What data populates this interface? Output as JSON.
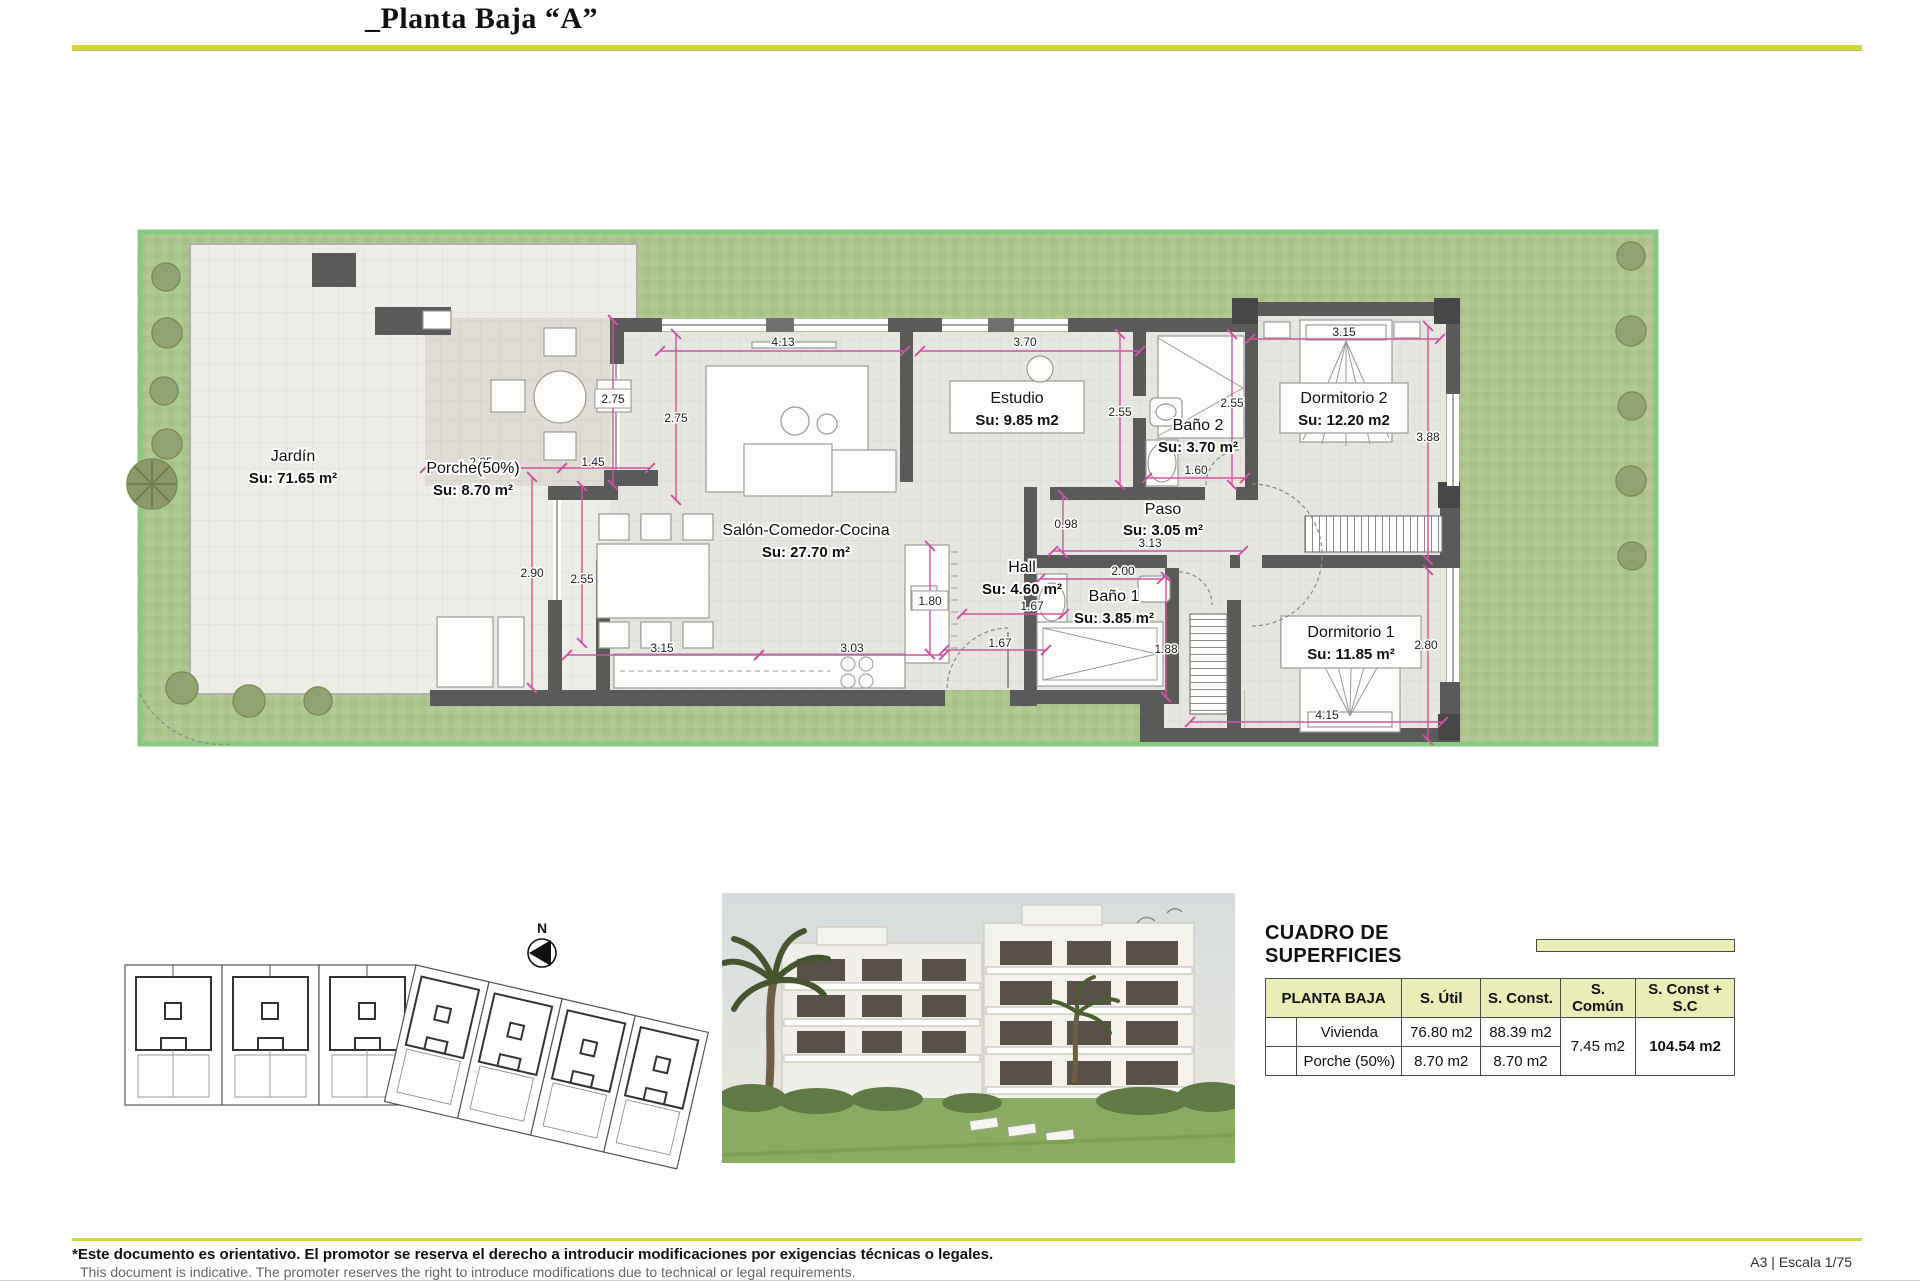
{
  "page": {
    "title": "_Planta Baja “A”"
  },
  "plan": {
    "compass_label": "N",
    "rooms": [
      {
        "name": "Jardín",
        "area": "Su: 71.65 m²"
      },
      {
        "name": "Porche(50%)",
        "area": "Su: 8.70 m²"
      },
      {
        "name": "Salón-Comedor-Cocina",
        "area": "Su: 27.70 m²"
      },
      {
        "name": "Estudio",
        "area": "Su: 9.85 m2"
      },
      {
        "name": "Baño 2",
        "area": "Su: 3.70 m²"
      },
      {
        "name": "Dormitorio 2",
        "area": "Su: 12.20 m2"
      },
      {
        "name": "Paso",
        "area": "Su: 3.05 m²"
      },
      {
        "name": "Hall",
        "area": "Su: 4.60 m²"
      },
      {
        "name": "Baño 1",
        "area": "Su: 3.85 m²"
      },
      {
        "name": "Dormitorio 1",
        "area": "Su: 11.85 m²"
      }
    ],
    "dimensions": [
      "4.13",
      "3.70",
      "2.75",
      "2.75",
      "2.55",
      "2.55",
      "3.15",
      "3.88",
      "1.60",
      "0.98",
      "3.13",
      "2.00",
      "1.88",
      "2.80",
      "4.15",
      "2.25",
      "1.45",
      "2.90",
      "2.55",
      "1.80",
      "3.15",
      "3.03",
      "1.67",
      "1.67"
    ]
  },
  "surfaces": {
    "title": "CUADRO DE SUPERFICIES",
    "floor": "PLANTA BAJA",
    "col_util": "S. Útil",
    "col_const": "S. Const.",
    "col_comun": "S. Común",
    "col_total": "S. Const + S.C",
    "rows": [
      {
        "name": "Vivienda",
        "util": "76.80 m2",
        "const": "88.39 m2"
      },
      {
        "name": "Porche (50%)",
        "util": "8.70 m2",
        "const": "8.70 m2"
      }
    ],
    "comun": "7.45 m2",
    "total": "104.54 m2"
  },
  "footer": {
    "note_es": "*Este documento es orientativo. El promotor se reserva el derecho a introducir modificaciones por exigencias técnicas o legales.",
    "note_en": "This document is indicative. The promoter reserves the right to introduce modifications due to technical or legal requirements.",
    "sheet": "A3 | Escala 1/75"
  },
  "colors": {
    "accent": "#d4d83e",
    "table_header": "#e9edb6",
    "highlight": "#e4e8ac",
    "dimension": "#cf549f",
    "wall": "#5a5a5a",
    "grass": "#abc48d",
    "plot_border": "#87cb7e"
  }
}
